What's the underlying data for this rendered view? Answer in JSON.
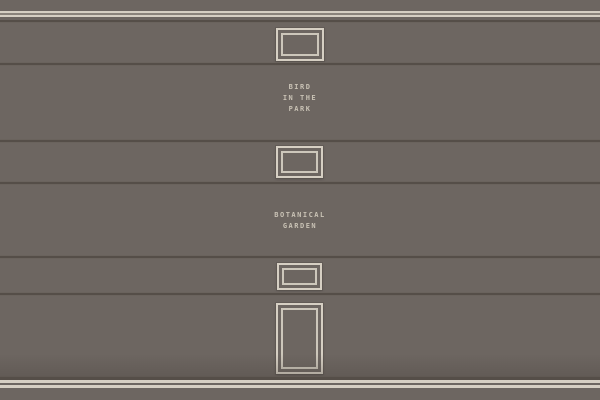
{
  "colors": {
    "wall": "#6d6661",
    "stripe_light": "#d6cfc3",
    "stripe_mid": "#8a837b",
    "dark_line": "#554e48",
    "frame_light": "#d6cfc3",
    "label_text": "#c9c2b5"
  },
  "wall": {
    "labels": [
      {
        "id": "bird-in-the-park",
        "lines": [
          "BIRD",
          "IN THE",
          "PARK"
        ]
      },
      {
        "id": "botanical-garden",
        "lines": [
          "BOTANICAL",
          "GARDEN"
        ]
      }
    ],
    "frames": [
      {
        "name": "small-picture-frame-top"
      },
      {
        "name": "small-picture-frame-middle"
      },
      {
        "name": "small-picture-frame-bottom"
      },
      {
        "name": "door-frame"
      }
    ]
  }
}
